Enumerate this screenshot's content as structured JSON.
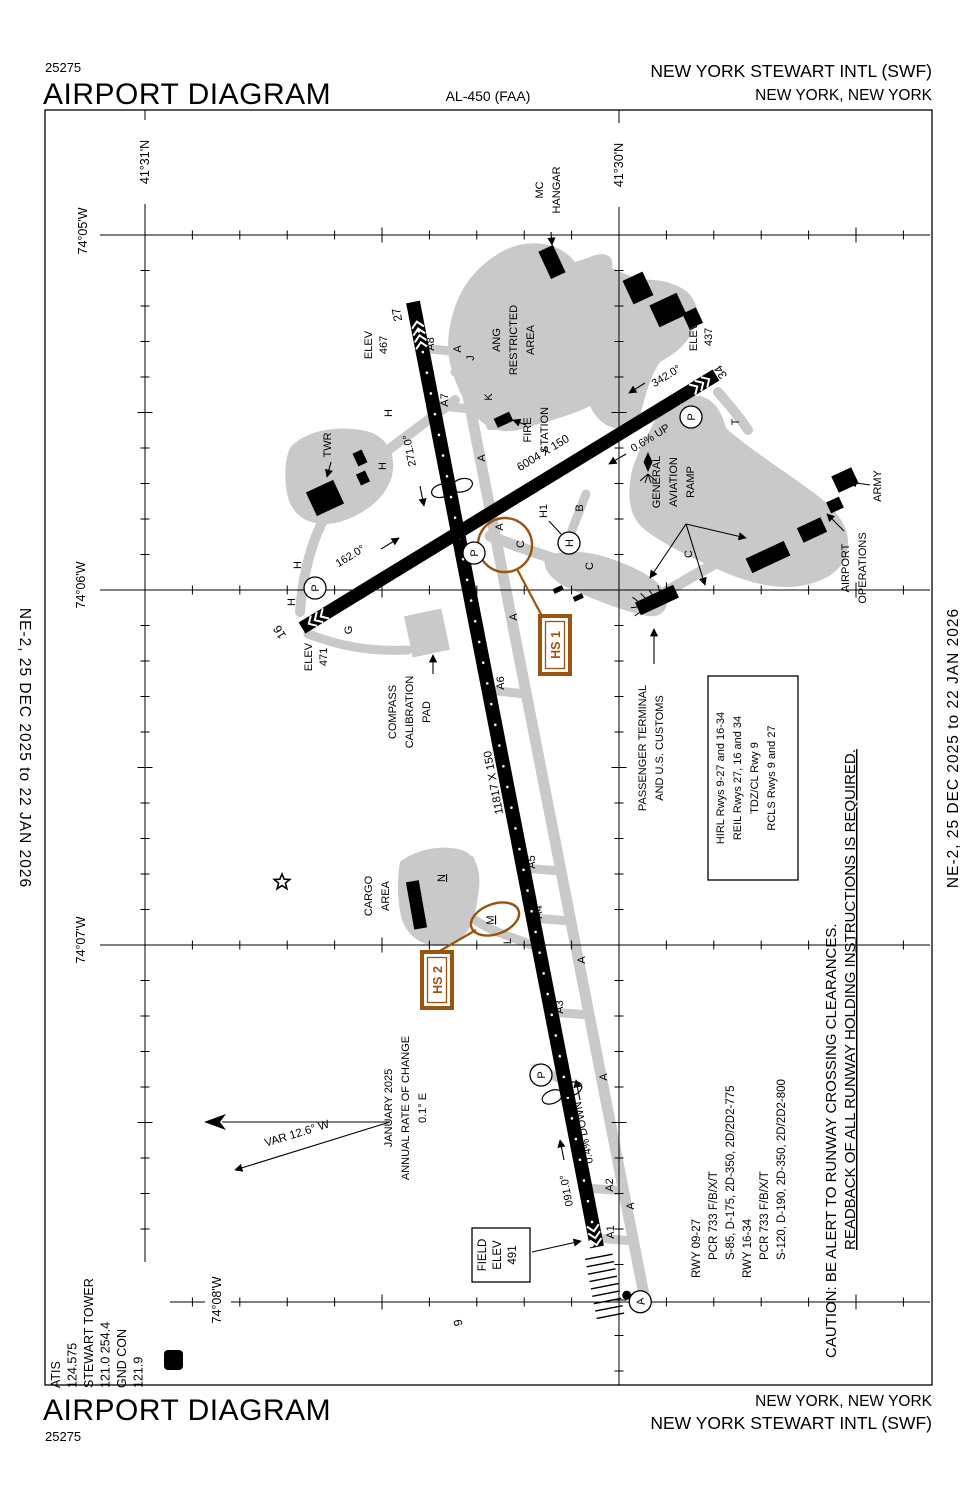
{
  "page": {
    "chart_number": "25275",
    "title": "AIRPORT DIAGRAM",
    "al_number": "AL-450 (FAA)",
    "airport_name": "NEW YORK STEWART INTL (SWF)",
    "city": "NEW YORK, NEW YORK",
    "effective_dates": "NE-2,  25 DEC 2025  to  22 JAN 2026"
  },
  "comms": {
    "l1": "ATIS",
    "l2": "124.575",
    "l3": "STEWART TOWER",
    "l4": "121.0  254.4",
    "l5": "GND CON",
    "l6": "121.9",
    "d_symbol": "D"
  },
  "coords": {
    "lat_31": "41°31'N",
    "lat_30": "41°30'N",
    "lon_05": "74°05'W",
    "lon_06": "74°06'W",
    "lon_07": "74°07'W",
    "lon_08": "74°08'W"
  },
  "runways": {
    "rwy_9_27": {
      "num_9": "9",
      "num_27": "27",
      "dim": "11817 X 150",
      "hdg_9": "091.0°",
      "hdg_27": "271.0°",
      "gradient": "0.4% DOWN",
      "elev_27_label": "ELEV",
      "elev_27_value": "467",
      "field_elev_l1": "FIELD",
      "field_elev_l2": "ELEV",
      "field_elev_l3": "491"
    },
    "rwy_16_34": {
      "num_16": "16",
      "num_34": "34",
      "dim": "6004 X 150",
      "hdg_16": "162.0°",
      "hdg_34": "342.0°",
      "gradient": "0.6% UP",
      "elev_16_label": "ELEV",
      "elev_16_value": "471",
      "elev_34_label": "ELEV",
      "elev_34_value": "437"
    }
  },
  "taxiways": {
    "a": "A",
    "a1": "A1",
    "a2": "A2",
    "a3": "A3",
    "a4": "A4",
    "a5": "A5",
    "a6": "A6",
    "a7": "A7",
    "a8": "A8",
    "b": "B",
    "c": "C",
    "g": "G",
    "h": "H",
    "h1": "H1",
    "j": "J",
    "k": "K",
    "l": "L",
    "m": "M",
    "n": "N",
    "p": "P",
    "t": "T"
  },
  "hotspots": {
    "hs1": "HS 1",
    "hs2": "HS 2"
  },
  "facilities": {
    "mc_hangar_l1": "MC",
    "mc_hangar_l2": "HANGAR",
    "ang_l1": "ANG",
    "ang_l2": "RESTRICTED",
    "ang_l3": "AREA",
    "fire_l1": "FIRE",
    "fire_l2": "STATION",
    "twr": "TWR",
    "ga_l1": "GENERAL",
    "ga_l2": "AVIATION",
    "ga_l3": "RAMP",
    "ops_l1": "AIRPORT",
    "ops_l2": "OPERATIONS",
    "army": "ARMY",
    "terminal_l1": "PASSENGER TERMINAL",
    "terminal_l2": "AND U.S. CUSTOMS",
    "compass_l1": "COMPASS",
    "compass_l2": "CALIBRATION",
    "compass_l3": "PAD",
    "cargo_l1": "CARGO",
    "cargo_l2": "AREA",
    "helipad": "H"
  },
  "variation": {
    "var_label": "VAR 12.6° W",
    "date": "JANUARY 2025",
    "rate_l1": "ANNUAL RATE OF CHANGE",
    "rate_l2": "0.1° E"
  },
  "lighting": {
    "l1": "HIRL Rwys 9-27 and 16-34",
    "l2": "REIL Rwys 27, 16 and 34",
    "l3": "TDZ/CL Rwy 9",
    "l4": "RCLS Rwys 9 and 27"
  },
  "runway_data": {
    "l1": "RWY 09-27",
    "l2": "PCR 733 F/B/X/T",
    "l3": "S-85, D-175, 2D-350, 2D/2D2-775",
    "l4": "RWY 16-34",
    "l5": "PCR 733 F/B/X/T",
    "l6": "S-120, D-190, 2D-350, 2D/2D2-800"
  },
  "caution": {
    "l1": "CAUTION: BE ALERT TO RUNWAY CROSSING CLEARANCES.",
    "l2": "READBACK OF ALL RUNWAY HOLDING INSTRUCTIONS IS REQUIRED."
  },
  "approach_light_symbol": "A",
  "colors": {
    "hotspot_brown": "#9b5310",
    "taxiway_gray": "#c9c9c9"
  }
}
